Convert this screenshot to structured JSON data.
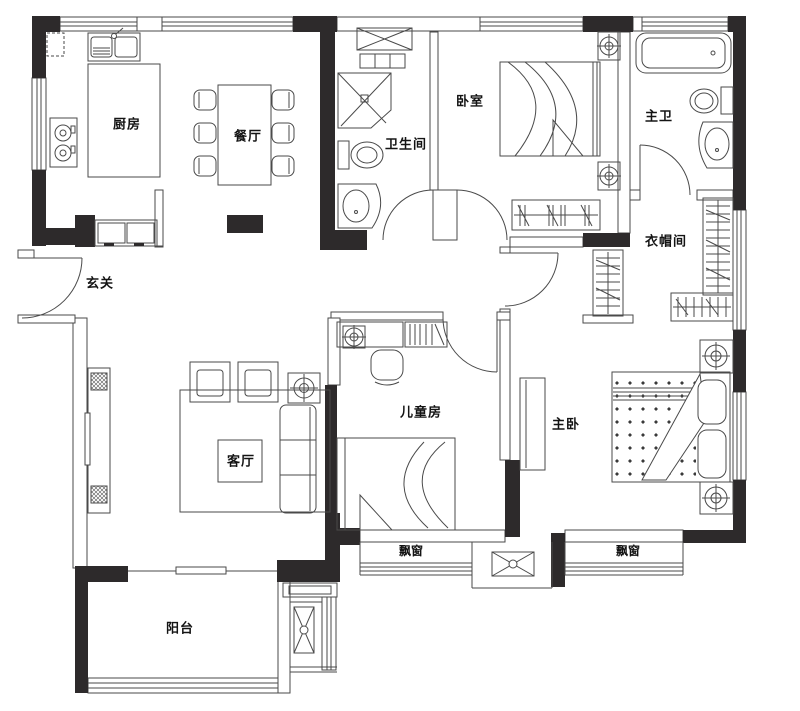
{
  "plan": {
    "rooms": {
      "kitchen": {
        "label": "厨房"
      },
      "dining": {
        "label": "餐厅"
      },
      "bathroom": {
        "label": "卫生间"
      },
      "bedroom": {
        "label": "卧室"
      },
      "master_bathroom": {
        "label": "主卫"
      },
      "cloakroom": {
        "label": "衣帽间"
      },
      "entry": {
        "label": "玄关"
      },
      "living_room": {
        "label": "客厅"
      },
      "kids_room": {
        "label": "儿童房"
      },
      "master_bedroom": {
        "label": "主卧"
      },
      "bay_window_left": {
        "label": "飘窗"
      },
      "bay_window_right": {
        "label": "飘窗"
      },
      "balcony": {
        "label": "阳台"
      }
    },
    "colors": {
      "wall_fill": "#2d2a2b",
      "line": "#4a4a4a",
      "background": "#ffffff"
    }
  }
}
